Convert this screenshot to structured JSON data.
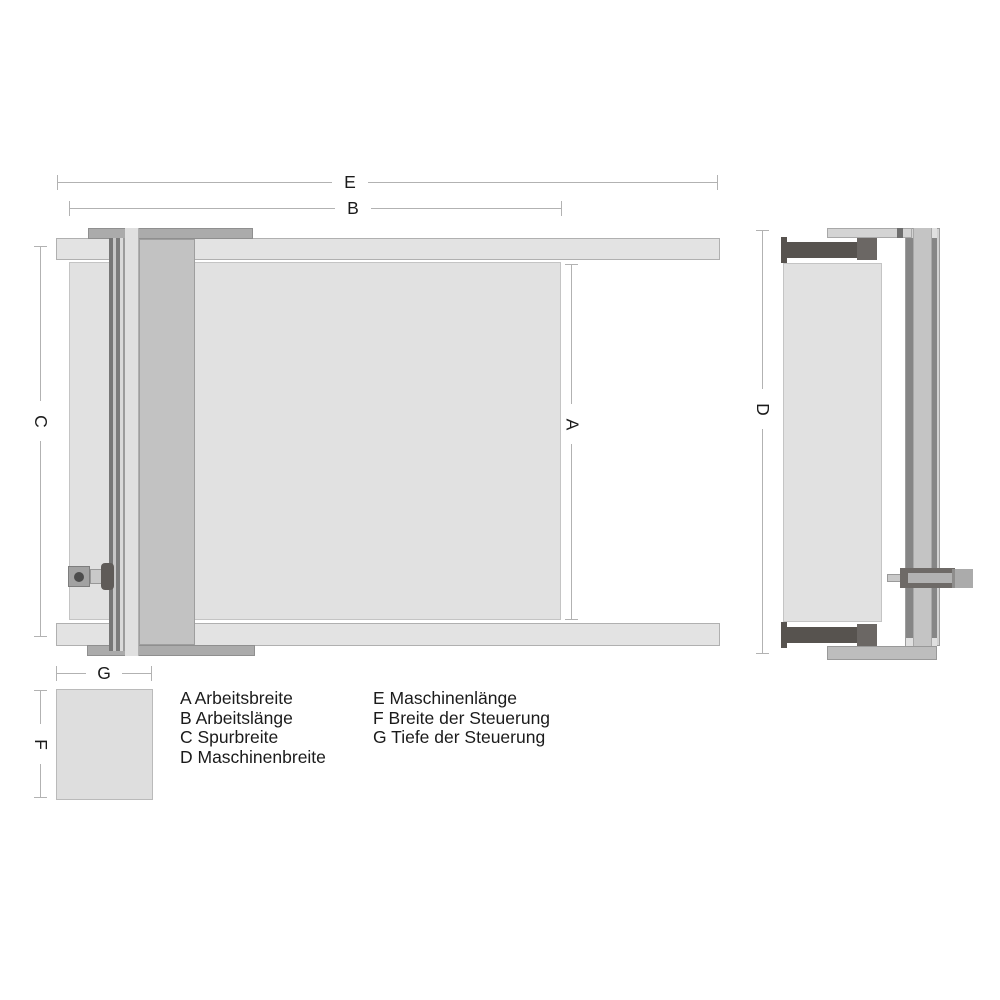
{
  "diagram_type": "machine-dimension-drawing",
  "dim_labels": {
    "A": "A",
    "B": "B",
    "C": "C",
    "D": "D",
    "E": "E",
    "F": "F",
    "G": "G"
  },
  "legend": {
    "col1": [
      "A Arbeitsbreite",
      "B Arbeitslänge",
      "C Spurbreite",
      "D Maschinenbreite"
    ],
    "col2": [
      "E Maschinenlänge",
      "F Breite der Steuerung",
      "G Tiefe der Steuerung"
    ]
  },
  "colors": {
    "background": "#ffffff",
    "dimension_line": "#b2b2b2",
    "text": "#1b1b1b",
    "light_panel": "#e1e1e1",
    "rail_bar": "#e3e3e3",
    "end_cap": "#ababab",
    "column": "#c2c2c2",
    "dark_part": "#57534f"
  }
}
